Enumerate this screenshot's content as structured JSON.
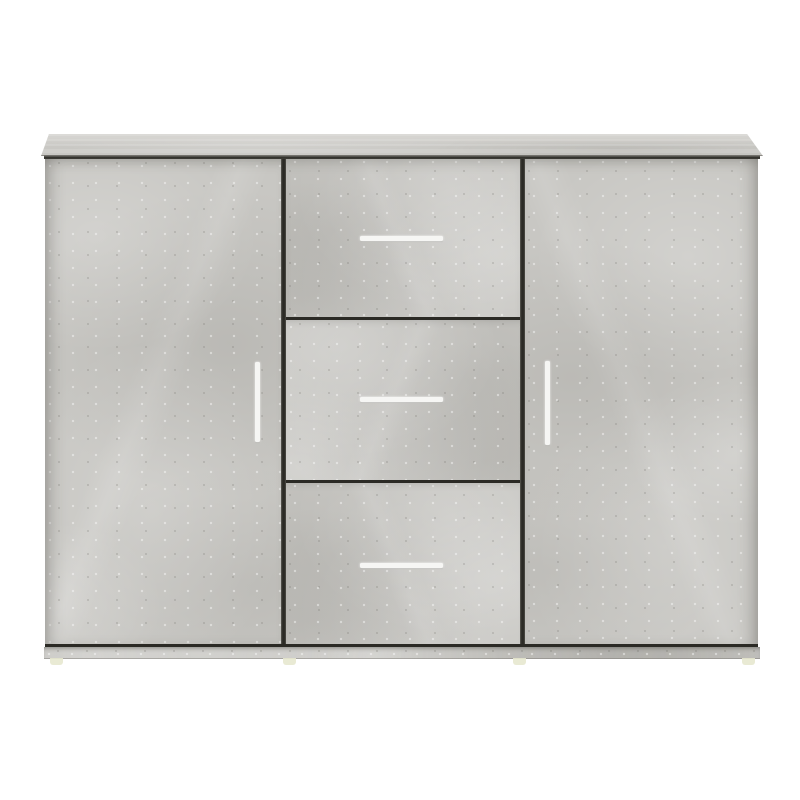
{
  "scene": {
    "description": "Product photo of a sideboard cabinet with a concrete gray finish, two doors and three center drawers, on a plain white background",
    "object": "sideboard",
    "finish": "concrete gray",
    "background": "white",
    "visible_text": ""
  },
  "colors": {
    "page_background": "#ffffff",
    "body_base": "#c8c7c3",
    "top_panel_base": "#c9c8c4",
    "top_panel_light": "#d8d7d3",
    "divider_line": "#2b2a25",
    "gap_shadow": "#2b2a25",
    "handle": "#f6f6f4",
    "plinth": "#c7c6c2",
    "foot": "#e7e8cf"
  },
  "structure": {
    "top_panel": "overhanging top board seen with slight perspective",
    "left_door": {
      "handle_style": "vertical white bar handle"
    },
    "drawers": [
      {
        "position": "top",
        "handle_style": "horizontal white bar handle"
      },
      {
        "position": "middle",
        "handle_style": "horizontal white bar handle"
      },
      {
        "position": "bottom",
        "handle_style": "horizontal white bar handle"
      }
    ],
    "right_door": {
      "handle_style": "vertical white bar handle"
    },
    "feet_count": 4
  }
}
